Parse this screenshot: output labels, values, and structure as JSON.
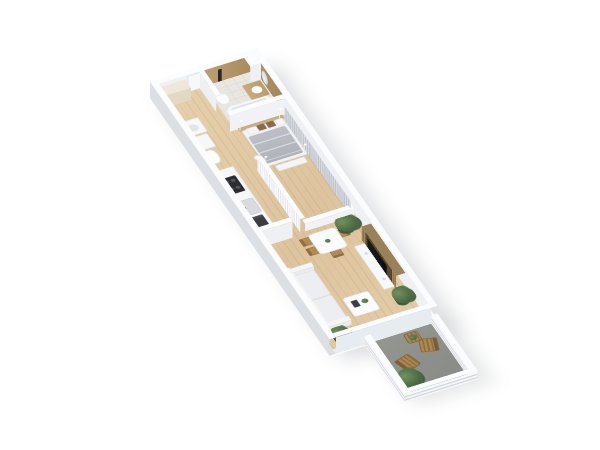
{
  "scene": {
    "description": "3D isometric render of a one-bedroom apartment floor plan on a white background, unit rotated diagonally with balcony at lower right",
    "background_color": "#ffffff",
    "view": "isometric-3d-floor-plan"
  },
  "palette": {
    "wall_top_white": "#fbfcfd",
    "wall_shadow": "#dce0e5",
    "wood_floor": "#e2cba6",
    "bathroom_tile_tan": "#b3956a",
    "bathroom_floor": "#eae7e2",
    "bed_gray": "#b9bdc3",
    "pillow_brown": "#8a6c4a",
    "curtain_gray": "#cfd3d9",
    "tv_black": "#141518",
    "tv_panel_wood": "#9b8159",
    "cooktop_black": "#2c2d31",
    "plant_green": "#4c6b45",
    "balcony_floor_gray": "#8e918d",
    "outdoor_wood": "#a8834f",
    "wardrobe_cream": "#efe8da",
    "sofa_white": "#f0f1f4"
  },
  "rooms": [
    {
      "name": "entry-hall",
      "items": [
        "wardrobe",
        "entry-door",
        "washing-machine",
        "cabinet",
        "toilet"
      ]
    },
    {
      "name": "bathroom",
      "items": [
        "bathtub",
        "shower-column",
        "vanity",
        "round-mirror",
        "toilet",
        "installation-shaft"
      ]
    },
    {
      "name": "kitchen",
      "items": [
        "counter",
        "cooktop",
        "sink",
        "oven"
      ]
    },
    {
      "name": "bedroom",
      "items": [
        "double-bed",
        "pillows",
        "headboard",
        "bed-bench",
        "floor-lamp",
        "window-curtains",
        "slat-partition"
      ]
    },
    {
      "name": "living-room",
      "items": [
        "dining-table",
        "dining-chairs",
        "tv-slat-wall",
        "tv",
        "media-console",
        "sofa",
        "coffee-table",
        "potted-plants",
        "window-curtains"
      ]
    },
    {
      "name": "balcony",
      "items": [
        "wooden-chair",
        "wooden-chair",
        "side-table",
        "potted-plants",
        "slotted-parapet"
      ]
    }
  ]
}
